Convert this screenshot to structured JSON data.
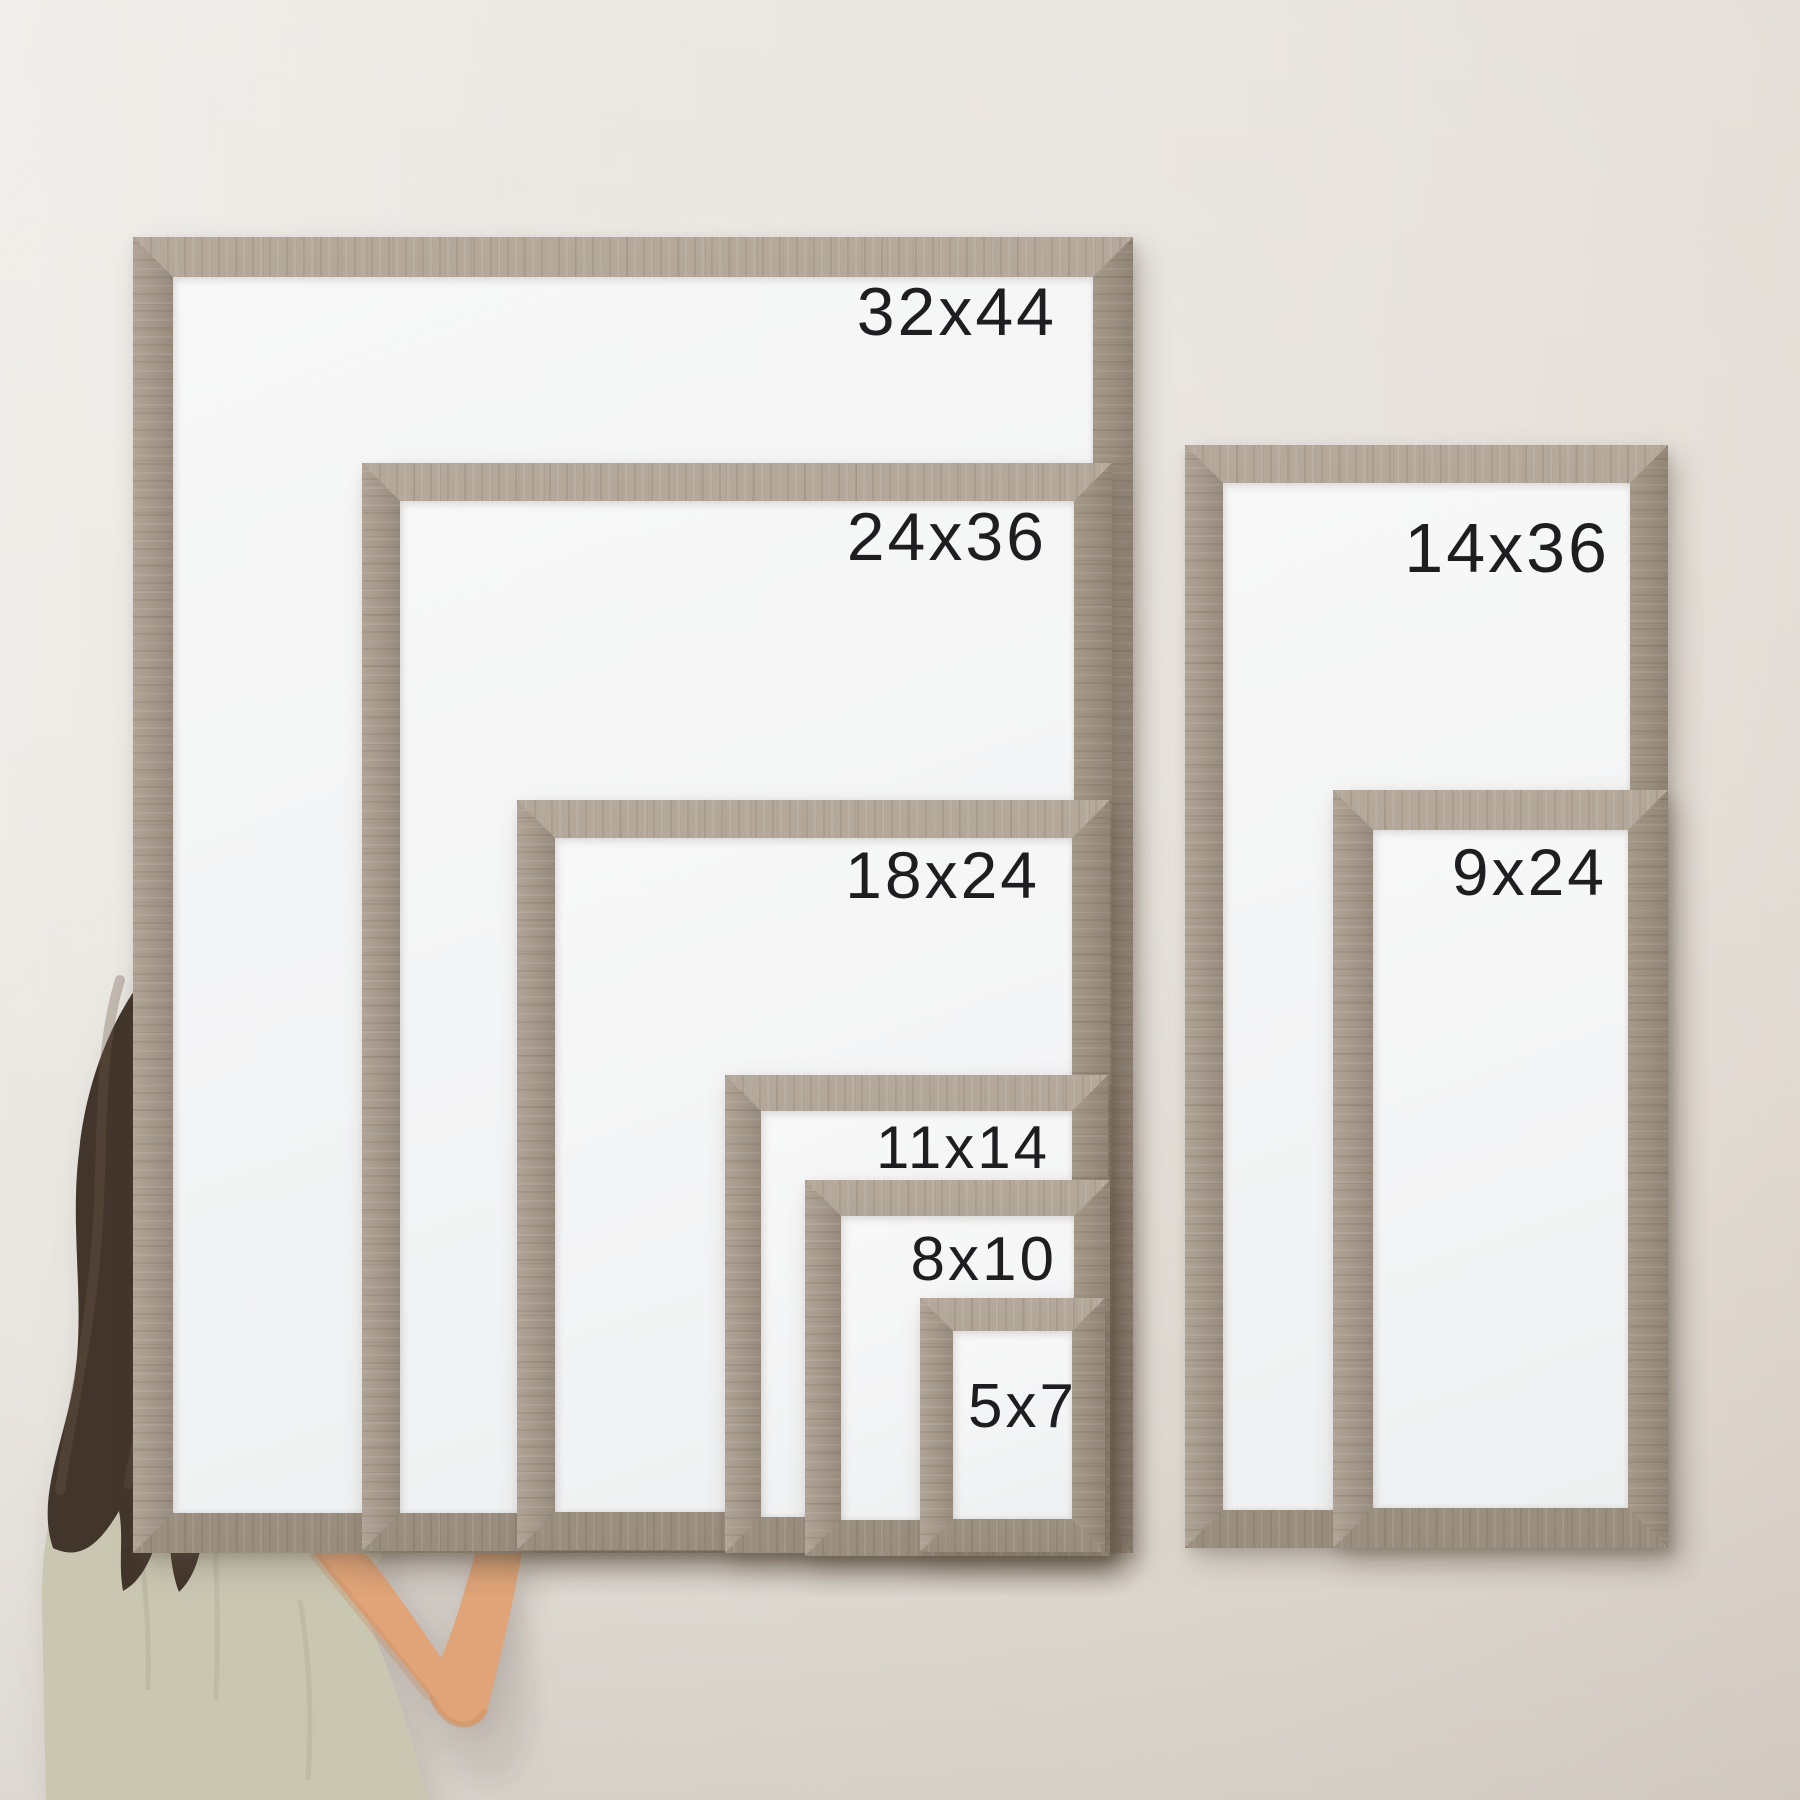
{
  "scene": {
    "description": "Size-comparison photo: woman writing with a dry-erase marker on nested rustic wood framed whiteboards hung on a wall",
    "size_labels": [
      "32x44",
      "24x36",
      "18x24",
      "11x14",
      "8x10",
      "5x7",
      "14x36",
      "9x24"
    ]
  },
  "person": {
    "role": "woman-writing-on-whiteboard",
    "held_item": "dry-erase-marker"
  },
  "colors": {
    "wall_top": "#ebe8e3",
    "wall_bottom": "#dad5cd",
    "wood": "#a89c8d",
    "wood_dark": "#978b7d",
    "board_white": "#f4f5f5",
    "label_text": "#1e1e20",
    "hair": "#42352b",
    "skin": "#e3a97e",
    "shirt": "#c9c6b2"
  },
  "frames": [
    {
      "label": "32x44",
      "x": 133,
      "y": 237,
      "w": 1000,
      "h": 1316,
      "bw": 40,
      "label_size": 68,
      "label_top": 41,
      "label_right": 76
    },
    {
      "label": "24x36",
      "x": 362,
      "y": 463,
      "w": 750,
      "h": 1088,
      "bw": 38,
      "label_size": 68,
      "label_top": 40,
      "label_right": 65
    },
    {
      "label": "18x24",
      "x": 517,
      "y": 800,
      "w": 593,
      "h": 750,
      "bw": 38,
      "label_size": 66,
      "label_top": 42,
      "label_right": 70
    },
    {
      "label": "11x14",
      "x": 725,
      "y": 1075,
      "w": 383,
      "h": 478,
      "bw": 36,
      "label_size": 60,
      "label_top": 43,
      "label_right": 58
    },
    {
      "label": "8x10",
      "x": 805,
      "y": 1180,
      "w": 305,
      "h": 376,
      "bw": 36,
      "label_size": 62,
      "label_top": 49,
      "label_right": 53
    },
    {
      "label": "5x7",
      "x": 920,
      "y": 1298,
      "w": 185,
      "h": 254,
      "bw": 33,
      "label_size": 62,
      "label_top": 78,
      "label_right": 28
    },
    {
      "label": "14x36",
      "x": 1185,
      "y": 445,
      "w": 483,
      "h": 1103,
      "bw": 38,
      "label_size": 70,
      "label_top": 68,
      "label_right": 58
    },
    {
      "label": "9x24",
      "x": 1333,
      "y": 790,
      "w": 335,
      "h": 758,
      "bw": 40,
      "label_size": 66,
      "label_top": 49,
      "label_right": 61
    }
  ]
}
